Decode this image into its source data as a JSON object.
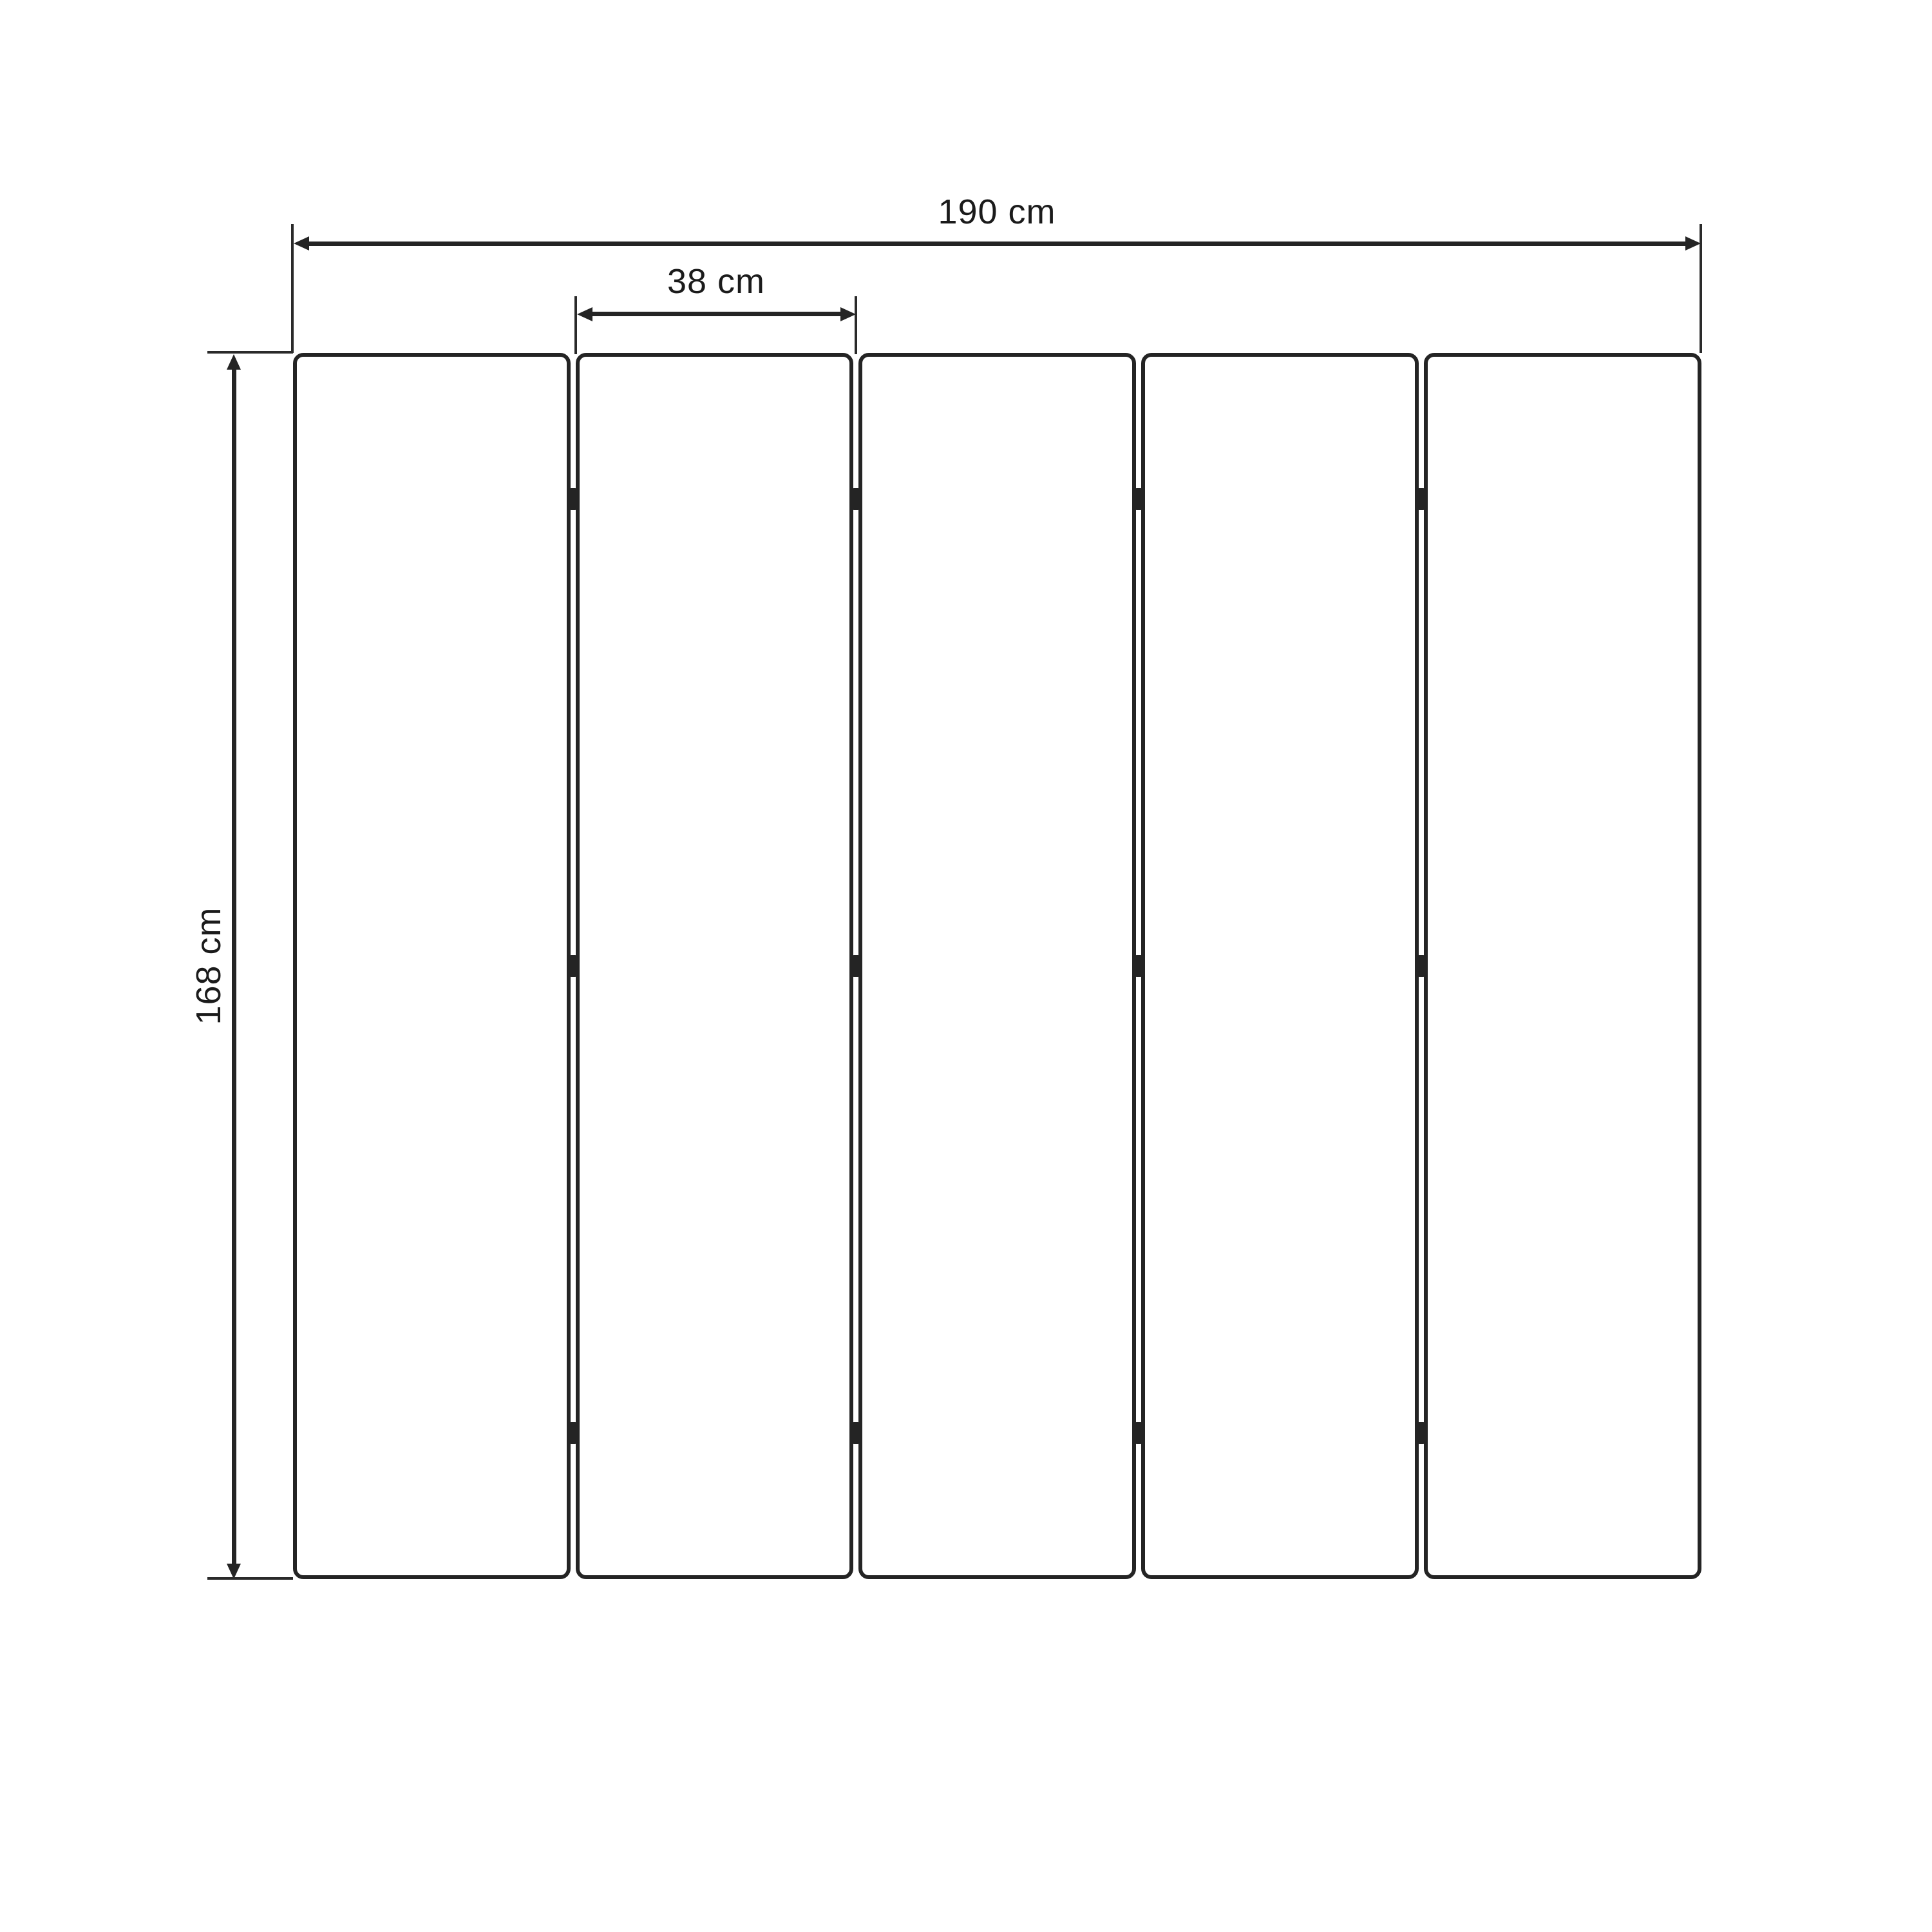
{
  "diagram": {
    "subject": "five-panel folding screen, front elevation",
    "panel_count": 5,
    "hinges_per_joint": 3,
    "dimensions": {
      "total_width": "190 cm",
      "panel_width": "38 cm",
      "height": "168 cm"
    },
    "colors": {
      "line": "#242424",
      "text": "#1b1b1b",
      "background": "#ffffff"
    }
  }
}
